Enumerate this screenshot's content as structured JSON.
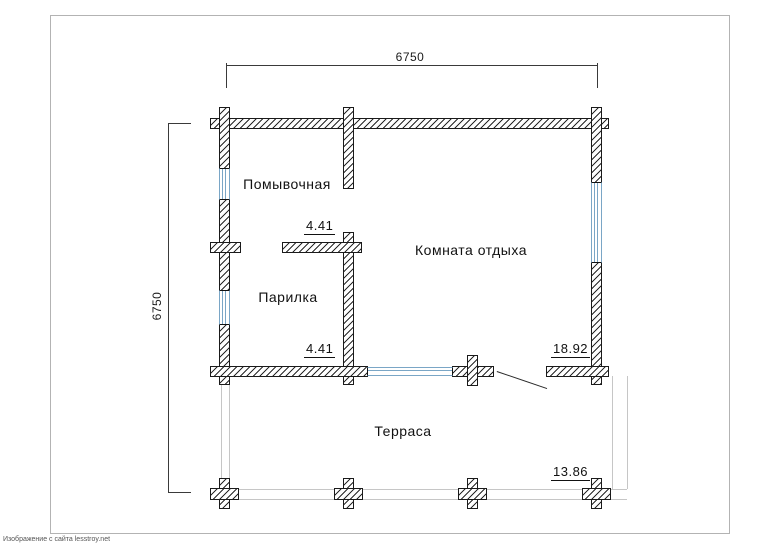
{
  "watermark": "Изображение с сайта lesstroy.net",
  "dimensions": {
    "top_width_mm": "6750",
    "left_height_mm": "6750"
  },
  "rooms": [
    {
      "name": "Помывочная",
      "area": "4.41"
    },
    {
      "name": "Парилка",
      "area": "4.41"
    },
    {
      "name": "Комната отдыха",
      "area": "18.92"
    },
    {
      "name": "Терраса",
      "area": "13.86"
    }
  ],
  "colors": {
    "wall_line": "#1a1a1a",
    "window_glass": "#7aa6c6",
    "terrace_outline": "#c6c6c6",
    "dimension_line": "#3a3a3a",
    "page_border": "#b3b3b3",
    "background": "#ffffff"
  }
}
